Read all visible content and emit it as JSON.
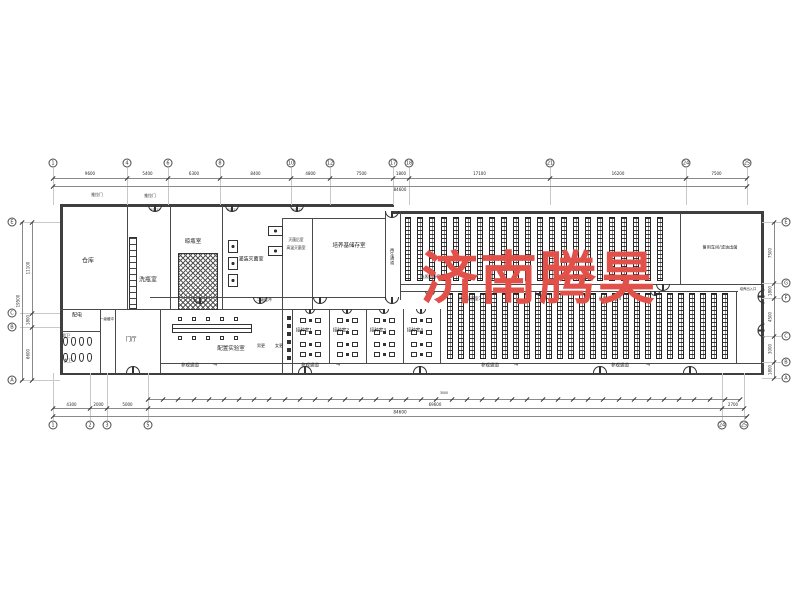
{
  "watermark": {
    "text": "济南腾昊",
    "color": "#e2504a"
  },
  "theme": {
    "wall_color": "#3f3f3f",
    "partition_color": "#4a4a4a",
    "dim_line_color": "#8a8a8a",
    "grid_line_color": "#c9c9c9",
    "rack_color": "#222222",
    "text_color": "#1f1f1f"
  },
  "grid": {
    "top": [
      {
        "x": 53,
        "n": "1"
      },
      {
        "x": 127,
        "n": "4"
      },
      {
        "x": 168,
        "n": "6"
      },
      {
        "x": 220,
        "n": "8"
      },
      {
        "x": 291,
        "n": "10"
      },
      {
        "x": 330,
        "n": "12"
      },
      {
        "x": 393,
        "n": "17"
      },
      {
        "x": 409,
        "n": "18"
      },
      {
        "x": 550,
        "n": "21"
      },
      {
        "x": 686,
        "n": "24"
      },
      {
        "x": 747,
        "n": "25"
      }
    ],
    "bottom": [
      {
        "x": 53,
        "n": "1"
      },
      {
        "x": 90,
        "n": "2"
      },
      {
        "x": 107,
        "n": "3"
      },
      {
        "x": 148,
        "n": "5"
      },
      {
        "x": 722,
        "n": "24"
      },
      {
        "x": 744,
        "n": "25"
      }
    ],
    "left": [
      {
        "y": 222,
        "n": "E"
      },
      {
        "y": 313,
        "n": "C"
      },
      {
        "y": 327,
        "n": "B"
      },
      {
        "y": 380,
        "n": "A"
      }
    ],
    "right": [
      {
        "y": 222,
        "n": "E"
      },
      {
        "y": 283,
        "n": "G"
      },
      {
        "y": 298,
        "n": "F"
      },
      {
        "y": 336,
        "n": "C"
      },
      {
        "y": 362,
        "n": "B"
      },
      {
        "y": 378,
        "n": "A"
      }
    ]
  },
  "dims": {
    "top_values": [
      "9600",
      "5400",
      "6300",
      "8400",
      "4800",
      "7500",
      "1800",
      "17100",
      "16200",
      "7500"
    ],
    "top_overall": "84600",
    "bottom_values": [
      "4300",
      "2000",
      "5000",
      "69600",
      "2700"
    ],
    "bottom_overall": "84600",
    "bottom_small": {
      "count": 39,
      "value": "3000"
    },
    "left_values": [
      "11100",
      "1800",
      "6600"
    ],
    "left_overall": "19500",
    "right_values": [
      "7500",
      "1800",
      "4500",
      "3000",
      "1800"
    ]
  },
  "labels": [
    {
      "t": "仓库",
      "x": 88,
      "y": 262,
      "s": 6
    },
    {
      "t": "洗瓶室",
      "x": 148,
      "y": 281,
      "s": 6
    },
    {
      "t": "晾瓶室",
      "x": 193,
      "y": 242,
      "s": 5.5
    },
    {
      "t": "灌装灭菌室",
      "x": 251,
      "y": 260,
      "s": 5
    },
    {
      "t": "灭菌后室",
      "x": 296,
      "y": 240,
      "s": 3.8
    },
    {
      "t": "高温灭菌室",
      "x": 296,
      "y": 248,
      "s": 3.8
    },
    {
      "t": "培养基储存室",
      "x": 349,
      "y": 246,
      "s": 5.5
    },
    {
      "t": "再生通道",
      "x": 392,
      "y": 256,
      "s": 4.2,
      "v": true
    },
    {
      "t": "光照培养室1",
      "x": 432,
      "y": 277,
      "s": 4
    },
    {
      "t": "光照培养室2",
      "x": 566,
      "y": 277,
      "s": 4
    },
    {
      "t": "光照培养室3",
      "x": 470,
      "y": 299,
      "s": 4
    },
    {
      "t": "光照培养室4",
      "x": 610,
      "y": 299,
      "s": 4
    },
    {
      "t": "备用车间/滤油出菌",
      "x": 720,
      "y": 248,
      "s": 4.2
    },
    {
      "t": "配电",
      "x": 77,
      "y": 316,
      "s": 5
    },
    {
      "t": "男卫",
      "x": 66,
      "y": 336,
      "s": 4
    },
    {
      "t": "女卫",
      "x": 68,
      "y": 361,
      "s": 4
    },
    {
      "t": "门厅",
      "x": 131,
      "y": 340,
      "s": 5.5
    },
    {
      "t": "一级缓冲",
      "x": 107,
      "y": 320,
      "s": 3.5
    },
    {
      "t": "二级缓冲",
      "x": 264,
      "y": 300,
      "s": 3.8
    },
    {
      "t": "配置实验室",
      "x": 231,
      "y": 349,
      "s": 5.5
    },
    {
      "t": "男更",
      "x": 261,
      "y": 346,
      "s": 4
    },
    {
      "t": "女更",
      "x": 279,
      "y": 346,
      "s": 4
    },
    {
      "t": "接种室1",
      "x": 304,
      "y": 332,
      "s": 4.5
    },
    {
      "t": "接种室2",
      "x": 341,
      "y": 332,
      "s": 4.5
    },
    {
      "t": "接种室3",
      "x": 378,
      "y": 332,
      "s": 4.5
    },
    {
      "t": "接种室4",
      "x": 415,
      "y": 332,
      "s": 4.5
    },
    {
      "t": "参观通道",
      "x": 190,
      "y": 367,
      "s": 4.5
    },
    {
      "t": "参观通道",
      "x": 310,
      "y": 367,
      "s": 4.5
    },
    {
      "t": "参观通道",
      "x": 490,
      "y": 367,
      "s": 4.5
    },
    {
      "t": "参观通道",
      "x": 620,
      "y": 367,
      "s": 4.5
    },
    {
      "t": "培养出入口",
      "x": 748,
      "y": 290,
      "s": 3.3
    },
    {
      "t": "推拉门",
      "x": 97,
      "y": 195,
      "s": 3.8
    },
    {
      "t": "推拉门",
      "x": 150,
      "y": 196,
      "s": 3.8
    },
    {
      "t": "M1521",
      "x": 155,
      "y": 210,
      "s": 3
    },
    {
      "t": "M1521",
      "x": 232,
      "y": 210,
      "s": 3
    },
    {
      "t": "M1521",
      "x": 297,
      "y": 210,
      "s": 3
    },
    {
      "t": "→",
      "x": 215,
      "y": 366,
      "s": 5
    },
    {
      "t": "→",
      "x": 338,
      "y": 366,
      "s": 5
    },
    {
      "t": "→",
      "x": 516,
      "y": 366,
      "s": 5
    },
    {
      "t": "→",
      "x": 648,
      "y": 366,
      "s": 5
    }
  ],
  "plan": {
    "walls": [
      [
        60,
        204,
        334,
        2.5
      ],
      [
        393,
        211,
        370,
        2.5
      ],
      [
        60,
        204,
        2.5,
        171
      ],
      [
        761,
        211,
        2.5,
        164
      ],
      [
        60,
        372.5,
        703.5,
        2.5
      ],
      [
        127,
        206,
        1.2,
        104
      ],
      [
        170,
        206,
        1.2,
        104
      ],
      [
        222,
        206,
        1.2,
        104
      ],
      [
        282,
        218,
        1.2,
        92
      ],
      [
        312,
        218,
        1.2,
        92
      ],
      [
        282,
        218,
        103,
        1.2
      ],
      [
        385,
        211,
        1.2,
        89
      ],
      [
        400,
        211,
        1.2,
        89
      ],
      [
        680,
        213,
        1.2,
        71
      ],
      [
        60,
        309,
        325,
        1.2
      ],
      [
        150,
        297,
        235,
        1.2
      ],
      [
        60,
        331,
        40,
        1.2
      ],
      [
        100,
        309,
        1.2,
        64
      ],
      [
        115,
        309,
        1.2,
        64
      ],
      [
        160,
        309,
        1.2,
        64
      ],
      [
        282,
        309,
        1.2,
        64
      ],
      [
        292,
        309,
        1.2,
        64
      ],
      [
        329,
        309,
        1.2,
        54
      ],
      [
        366,
        309,
        1.2,
        54
      ],
      [
        403,
        309,
        1.2,
        54
      ],
      [
        440,
        309,
        1.2,
        54
      ],
      [
        400,
        283.5,
        361,
        1.5
      ],
      [
        400,
        290.5,
        338,
        1.5
      ],
      [
        160,
        362.5,
        601,
        1.2
      ],
      [
        736,
        291,
        1.2,
        72
      ]
    ],
    "doors": [
      {
        "x": 155,
        "y": 205,
        "o": "d"
      },
      {
        "x": 232,
        "y": 205,
        "o": "d"
      },
      {
        "x": 297,
        "y": 205,
        "o": "d"
      },
      {
        "x": 392,
        "y": 211,
        "o": "d"
      },
      {
        "x": 663,
        "y": 284,
        "o": "d"
      },
      {
        "x": 200,
        "y": 297,
        "o": "d"
      },
      {
        "x": 260,
        "y": 297,
        "o": "d"
      },
      {
        "x": 320,
        "y": 297,
        "o": "d"
      },
      {
        "x": 392,
        "y": 297,
        "o": "d"
      },
      {
        "x": 310,
        "y": 309,
        "o": "d",
        "w": 10
      },
      {
        "x": 347,
        "y": 309,
        "o": "d",
        "w": 10
      },
      {
        "x": 384,
        "y": 309,
        "o": "d",
        "w": 10
      },
      {
        "x": 421,
        "y": 309,
        "o": "d",
        "w": 10
      },
      {
        "x": 430,
        "y": 291,
        "o": "d",
        "w": 10
      },
      {
        "x": 540,
        "y": 291,
        "o": "d",
        "w": 10
      },
      {
        "x": 655,
        "y": 291,
        "o": "d",
        "w": 10
      },
      {
        "x": 133,
        "y": 373,
        "o": "u"
      },
      {
        "x": 305,
        "y": 373,
        "o": "u"
      },
      {
        "x": 420,
        "y": 373,
        "o": "u"
      },
      {
        "x": 600,
        "y": 373,
        "o": "u"
      },
      {
        "x": 690,
        "y": 373,
        "o": "u"
      },
      {
        "x": 761,
        "y": 296,
        "o": "l"
      },
      {
        "x": 761,
        "y": 330,
        "o": "l"
      }
    ],
    "rack_groups": [
      {
        "x": 405,
        "y": 217,
        "count": 22,
        "pitch": 12,
        "w": 6,
        "h": 64
      },
      {
        "x": 447,
        "y": 293,
        "count": 26,
        "pitch": 11,
        "w": 6,
        "h": 66
      }
    ],
    "hatch_area": {
      "x": 178,
      "y": 253,
      "w": 40,
      "h": 57
    },
    "drying_rack": {
      "x": 129,
      "y": 237,
      "w": 8,
      "h": 72
    },
    "equipment": [
      [
        228,
        240,
        10,
        13
      ],
      [
        228,
        257,
        10,
        13
      ],
      [
        228,
        274,
        10,
        13
      ],
      [
        268,
        226,
        15,
        10
      ],
      [
        268,
        246,
        15,
        10
      ]
    ],
    "lab_bench": {
      "x": 172,
      "y": 324,
      "w": 80,
      "h": 9
    },
    "lab_squares_top_y": 317,
    "lab_squares_bottom_y": 336,
    "lab_right_col_x": 287,
    "inoculation_room_x": [
      292,
      329,
      366,
      403
    ],
    "bench_rows_y": [
      318,
      330,
      342,
      352
    ],
    "toilet_rows_y": [
      337,
      353
    ]
  }
}
